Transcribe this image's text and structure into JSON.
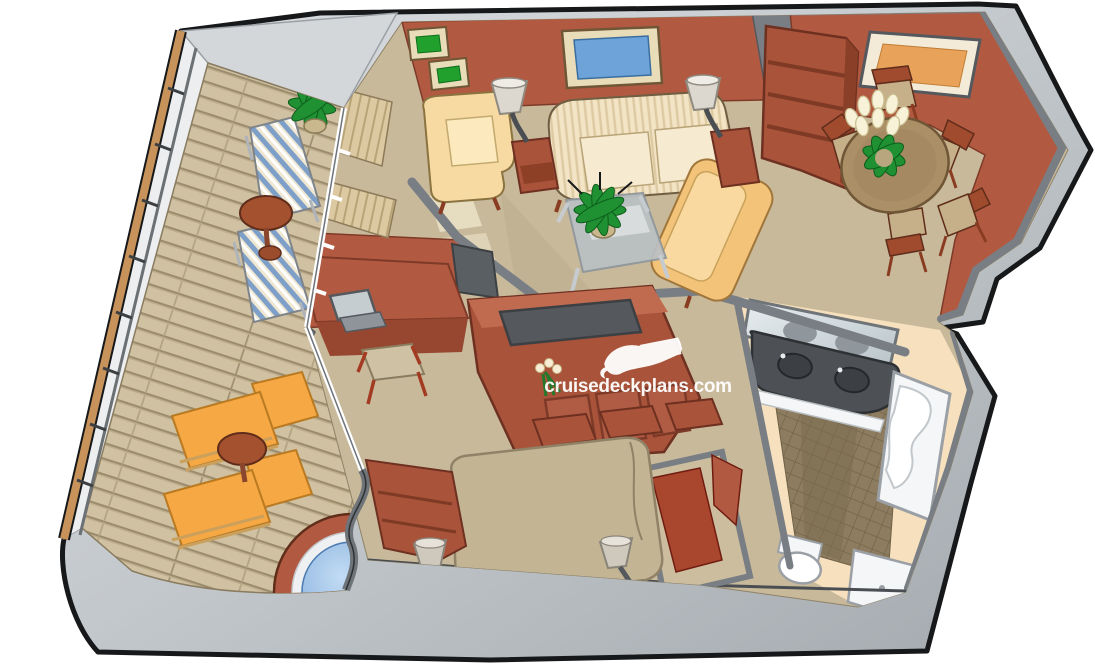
{
  "watermark": {
    "text": "cruisedeckplans.com",
    "icon": "cruise-ship-bow-icon",
    "color": "#ffffff"
  },
  "scene": {
    "kind": "isometric-cutaway-floorplan",
    "rooms": [
      "balcony-upper",
      "balcony-lower",
      "living-room",
      "dining-area",
      "bedroom",
      "bathroom"
    ],
    "objects": [
      "railing",
      "deck-lounger-striped",
      "deck-lounger-orange",
      "balcony-table",
      "potted-plant",
      "hot-tub",
      "sofa",
      "armchair",
      "loveseat",
      "coffee-table",
      "side-table",
      "table-lamp",
      "curtain",
      "picture-frame",
      "window",
      "dining-table",
      "dining-chair",
      "flower-vase",
      "bookshelf",
      "desk",
      "laptop",
      "desk-chair",
      "tv",
      "tv-credenza",
      "bed",
      "nightstand-lamp",
      "dresser",
      "closet",
      "vanity-mirror",
      "double-sink-vanity",
      "bathtub",
      "toilet",
      "shower"
    ]
  },
  "palette": {
    "background": "#ffffff",
    "hull_light": "#d7dadd",
    "hull_dark": "#a7adb2",
    "wall_gray": "#787e84",
    "inner_face_gray": "#d4d7da",
    "outline": "#17181a",
    "wall_red": "#b25a41",
    "wall_red_dark": "#96462f",
    "furniture_red": "#a8533a",
    "carpet": "#c8b99b",
    "deck": "#cfc1a1",
    "deck_line": "#9b8c6e",
    "sofa_cream": "#f2e4c4",
    "chair_cream": "#f7d9a2",
    "loveseat_tan": "#f2c379",
    "lounger_orange": "#f6a844",
    "stripe_blue": "#7e9fc8",
    "hot_tub_water": "#85b1e0",
    "table_redbrown": "#a3512f",
    "dining_table": "#ab8f66",
    "seat_tan": "#c6b08a",
    "plant_green": "#1f9132",
    "bath_cream": "#f7e0bd",
    "tile": "#8d7c5f",
    "vanity_dark": "#4d5156",
    "fixture_white": "#f4f6f7",
    "glass_blue": "#6da3d8",
    "window_orange": "#e8a25a",
    "picture_green": "#22a02e",
    "picture_red": "#b03020",
    "bed_tan": "#c3b494",
    "rail_wood": "#c8935a"
  }
}
